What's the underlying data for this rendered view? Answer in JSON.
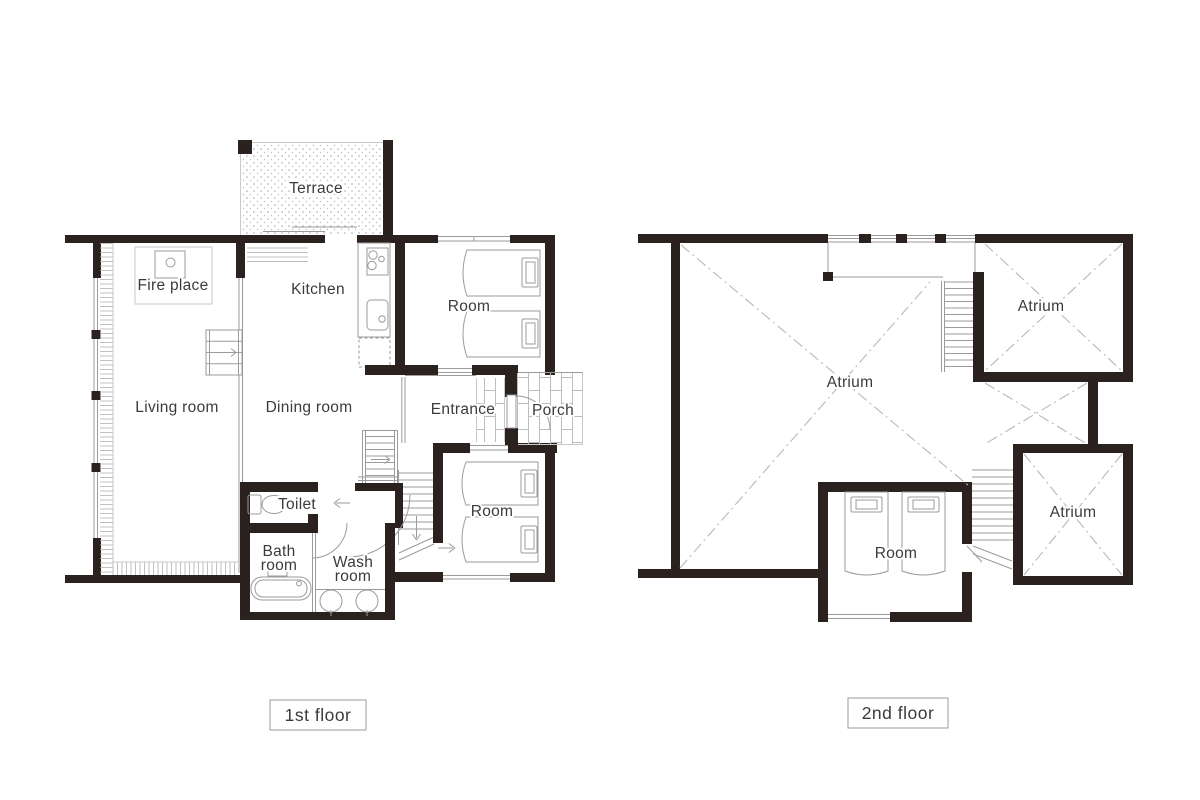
{
  "colors": {
    "bg": "#ffffff",
    "wall": "#2b2220",
    "line": "#9b9b9b",
    "light_line": "#c9c9c9",
    "dash": "#b8b8b8",
    "text": "#3b3b3b",
    "caption_border": "#9b9b9b"
  },
  "symbols": [
    "bed-icon",
    "pillow-icon",
    "toilet-icon",
    "bathtub-icon",
    "washbasin-icon",
    "stove-icon",
    "sink-icon",
    "refrigerator-icon",
    "stairs-icon",
    "door-swing-icon",
    "fireplace-icon",
    "void-cross-icon"
  ],
  "floors": [
    {
      "caption": "1st floor",
      "rooms": {
        "terrace": "Terrace",
        "fireplace": "Fire place",
        "kitchen": "Kitchen",
        "room_north": "Room",
        "living": "Living room",
        "dining": "Dining room",
        "entrance": "Entrance",
        "porch": "Porch",
        "toilet": "Toilet",
        "bath1": "Bath",
        "bath2": "room",
        "wash1": "Wash",
        "wash2": "room",
        "room_south": "Room"
      }
    },
    {
      "caption": "2nd floor",
      "rooms": {
        "atrium_main": "Atrium",
        "atrium_north": "Atrium",
        "atrium_south": "Atrium",
        "room": "Room"
      }
    }
  ]
}
